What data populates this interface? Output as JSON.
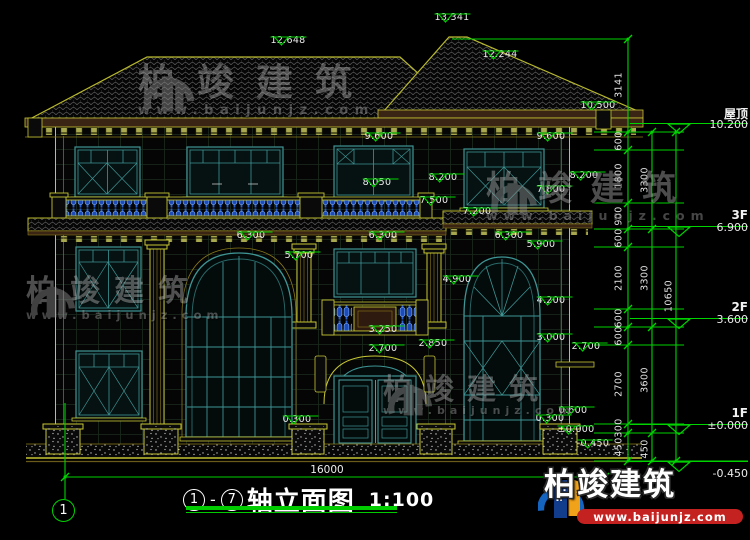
{
  "titleblock": {
    "axis_start": "1",
    "axis_end": "7",
    "dash": "-",
    "name": "轴立面图",
    "scale": "1:100"
  },
  "axis_bubble": "1",
  "overall_dim": "16000",
  "watermark": {
    "brand": "柏竣建筑",
    "site": "www.baijunjz.com"
  },
  "logo": {
    "brand": "柏竣建筑",
    "site": "www.baijunjz.com"
  },
  "levels": [
    {
      "name": "屋顶",
      "value": "10.200",
      "y": 132,
      "below": false
    },
    {
      "name": "3F",
      "value": "6.900",
      "y": 235,
      "below": false
    },
    {
      "name": "2F",
      "value": "3.600",
      "y": 327,
      "below": false
    },
    {
      "name": "1F",
      "value": "±0.000",
      "y": 433,
      "below": false
    },
    {
      "name": "",
      "value": "-0.450",
      "y": 461,
      "below": true
    }
  ],
  "markers": [
    {
      "t": "13.341",
      "x": 452,
      "y": 13
    },
    {
      "t": "12.648",
      "x": 288,
      "y": 36
    },
    {
      "t": "12.244",
      "x": 500,
      "y": 50
    },
    {
      "t": "10.500",
      "x": 598,
      "y": 101
    },
    {
      "t": "9.600",
      "x": 379,
      "y": 132
    },
    {
      "t": "9.600",
      "x": 551,
      "y": 132
    },
    {
      "t": "8.050",
      "x": 377,
      "y": 178
    },
    {
      "t": "8.200",
      "x": 443,
      "y": 173
    },
    {
      "t": "8.200",
      "x": 584,
      "y": 171
    },
    {
      "t": "7.800",
      "x": 551,
      "y": 185
    },
    {
      "t": "7.500",
      "x": 434,
      "y": 196
    },
    {
      "t": "7.200",
      "x": 477,
      "y": 207
    },
    {
      "t": "6.300",
      "x": 251,
      "y": 231
    },
    {
      "t": "6.300",
      "x": 383,
      "y": 231
    },
    {
      "t": "6.300",
      "x": 509,
      "y": 231
    },
    {
      "t": "5.900",
      "x": 541,
      "y": 240
    },
    {
      "t": "5.700",
      "x": 299,
      "y": 251
    },
    {
      "t": "4.900",
      "x": 457,
      "y": 275
    },
    {
      "t": "4.200",
      "x": 551,
      "y": 296
    },
    {
      "t": "3.250",
      "x": 383,
      "y": 325
    },
    {
      "t": "3.000",
      "x": 551,
      "y": 333
    },
    {
      "t": "2.850",
      "x": 433,
      "y": 339
    },
    {
      "t": "2.700",
      "x": 383,
      "y": 344
    },
    {
      "t": "2.700",
      "x": 586,
      "y": 342
    },
    {
      "t": "0.600",
      "x": 573,
      "y": 406
    },
    {
      "t": "0.300",
      "x": 297,
      "y": 415
    },
    {
      "t": "0.300",
      "x": 550,
      "y": 414
    },
    {
      "t": "±0.000",
      "x": 576,
      "y": 425
    },
    {
      "t": "-0.450",
      "x": 593,
      "y": 439
    }
  ],
  "chains": [
    {
      "x": 619,
      "segs": [
        {
          "v": "3141",
          "y": 85
        },
        {
          "v": "600",
          "y": 141
        },
        {
          "v": "1800",
          "y": 176
        },
        {
          "v": "900",
          "y": 216
        },
        {
          "v": "600",
          "y": 238
        },
        {
          "v": "2100",
          "y": 278
        },
        {
          "v": "600",
          "y": 318
        },
        {
          "v": "600",
          "y": 336
        },
        {
          "v": "2700",
          "y": 384
        },
        {
          "v": "300",
          "y": 428
        },
        {
          "v": "450",
          "y": 447
        }
      ]
    },
    {
      "x": 645,
      "segs": [
        {
          "v": "3300",
          "y": 180
        },
        {
          "v": "3300",
          "y": 278
        },
        {
          "v": "3600",
          "y": 380
        },
        {
          "v": "450",
          "y": 449
        }
      ]
    },
    {
      "x": 669,
      "segs": [
        {
          "v": "10650",
          "y": 296
        }
      ]
    }
  ],
  "colors": {
    "background": "#000000",
    "dim_green": "#00d400",
    "text_white": "#ebebeb",
    "outline_yellow": "#c6c634",
    "band_brown": "#3a2413",
    "window_teal": "#3f9494",
    "baluster_blue": "#2a5fd0",
    "watermark_gray": "#9a9a9a",
    "logo_blue": "#1565c0",
    "logo_orange": "#f0a21a",
    "logo_red": "#c42121"
  }
}
